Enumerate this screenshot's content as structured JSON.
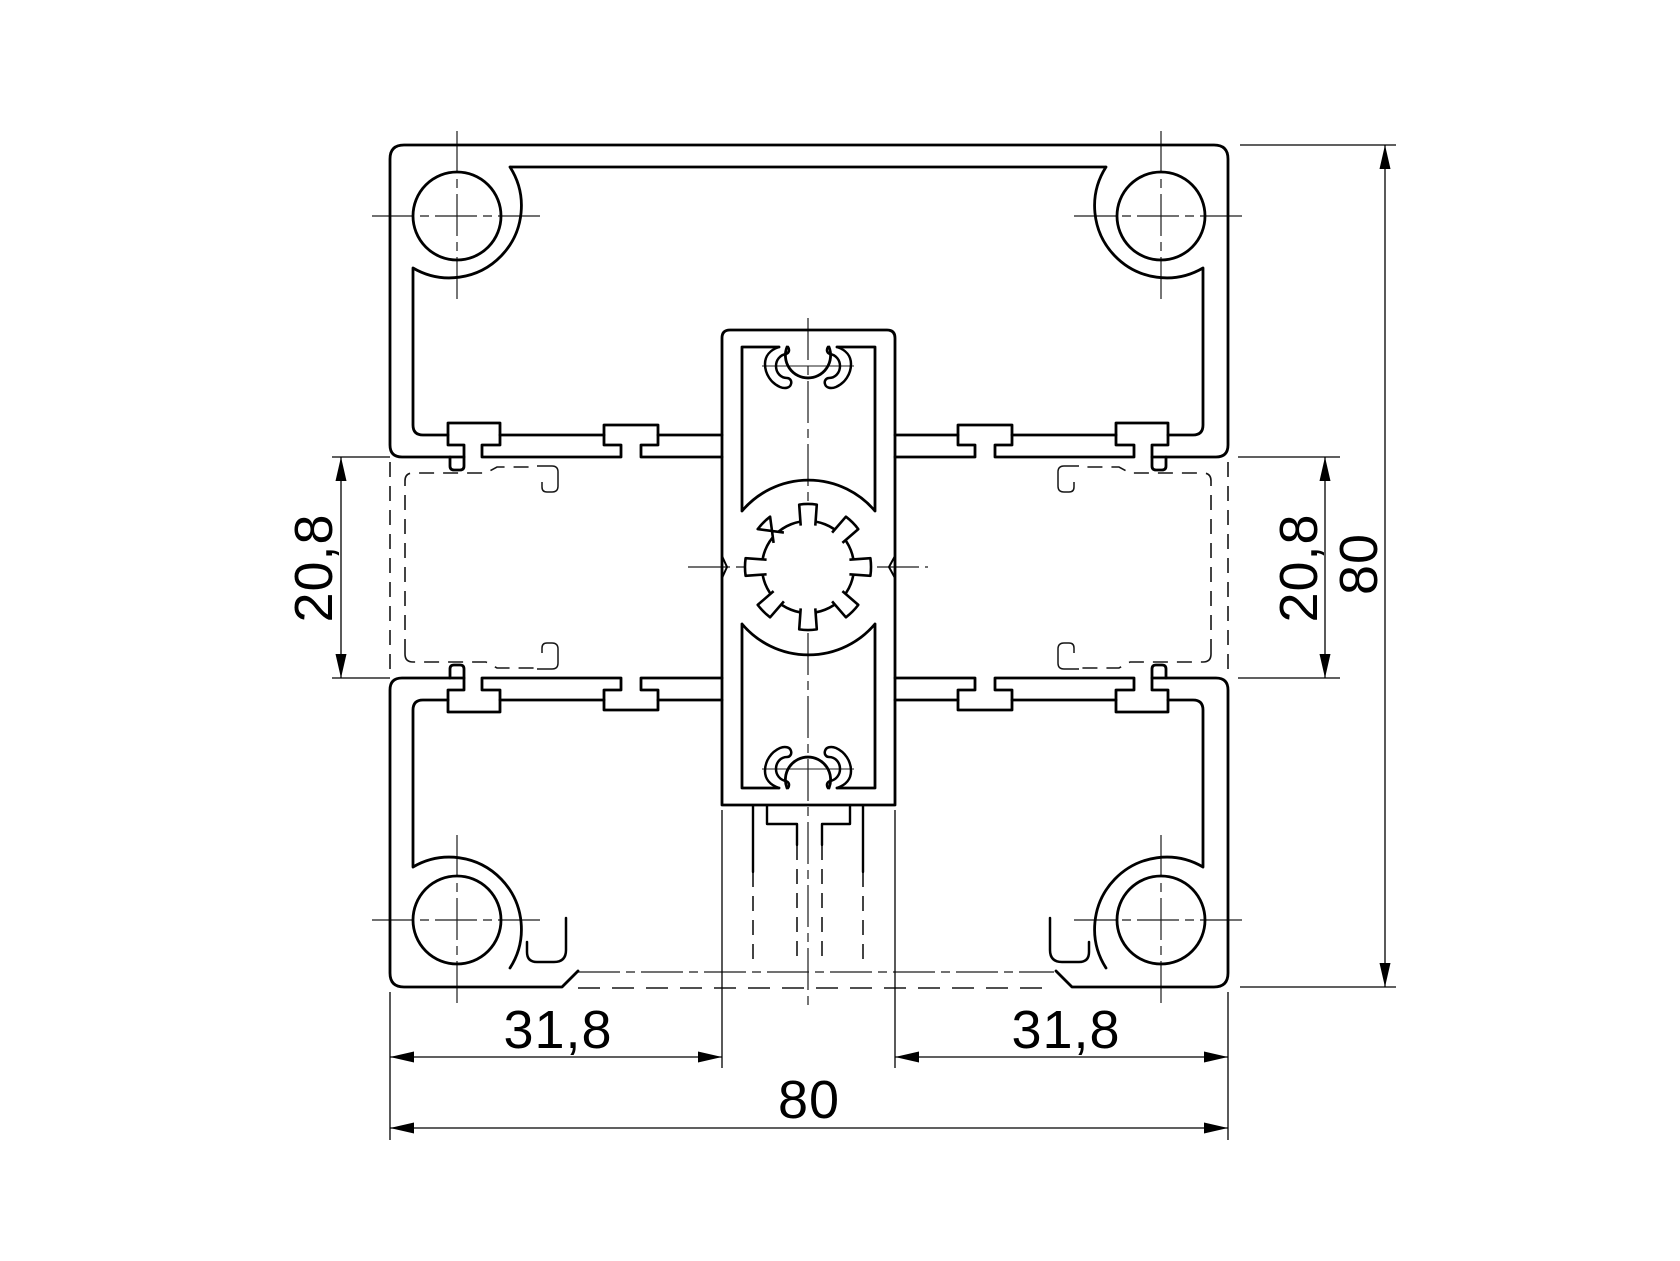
{
  "drawing": {
    "kind": "aluminium-extrusion-profile-cross-section",
    "colors": {
      "line": "#000000",
      "background": "#ffffff"
    },
    "dims": {
      "slot_left": {
        "label": "20,8"
      },
      "slot_right": {
        "label": "20,8"
      },
      "height": {
        "label": "80"
      },
      "bottom_left": {
        "label": "31,8"
      },
      "bottom_right": {
        "label": "31,8"
      },
      "width": {
        "label": "80"
      }
    }
  }
}
